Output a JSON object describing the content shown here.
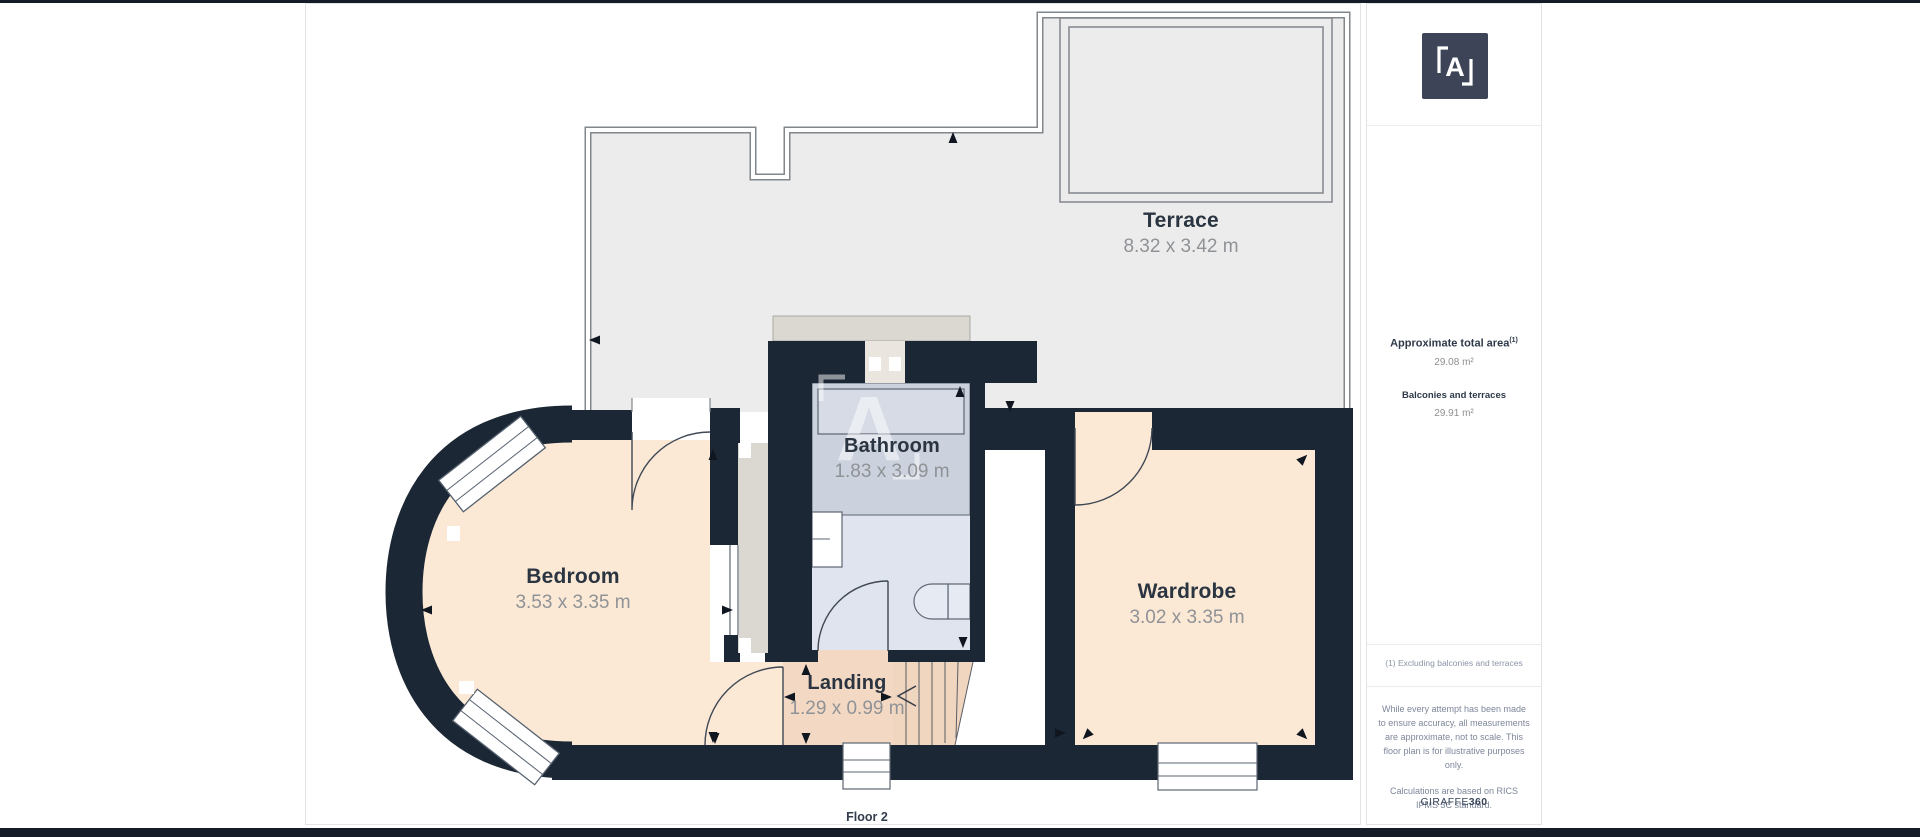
{
  "plan": {
    "floor_label": "Floor 2",
    "watermark_letter": "A",
    "rooms": [
      {
        "name": "Terrace",
        "dims": "8.32 x 3.42 m"
      },
      {
        "name": "Bathroom",
        "dims": "1.83 x 3.09 m"
      },
      {
        "name": "Bedroom",
        "dims": "3.53 x 3.35 m"
      },
      {
        "name": "Wardrobe",
        "dims": "3.02 x 3.35 m"
      },
      {
        "name": "Landing",
        "dims": "1.29 x 0.99 m"
      }
    ]
  },
  "sidebar": {
    "logo_letter": "A",
    "area_title": "Approximate total area",
    "area_title_sup": "(1)",
    "area_value": "29.08 m²",
    "balconies_title": "Balconies and terraces",
    "balconies_value": "29.91 m²",
    "footnote": "(1) Excluding balconies and terraces",
    "disclaimer_1": "While every attempt has been made to ensure accuracy, all measurements are approximate, not to scale. This floor plan is for illustrative purposes only.",
    "disclaimer_2": "Calculations are based on RICS IPMS 3C standard.",
    "brand_name": "GIRAFFE",
    "brand_number": "360"
  },
  "colors": {
    "wall": "#1c2735",
    "terrace": "#ececec",
    "peach": "#fbe9d5",
    "peach-dark": "#f3d9c3",
    "bath": "#dfe4ee",
    "bath-dark": "#ccd2dd",
    "shaft": "#dbd8d2",
    "logo": "#3e4457",
    "label": "#2b3542",
    "dim": "#8f9296",
    "bar": "#151c28"
  }
}
